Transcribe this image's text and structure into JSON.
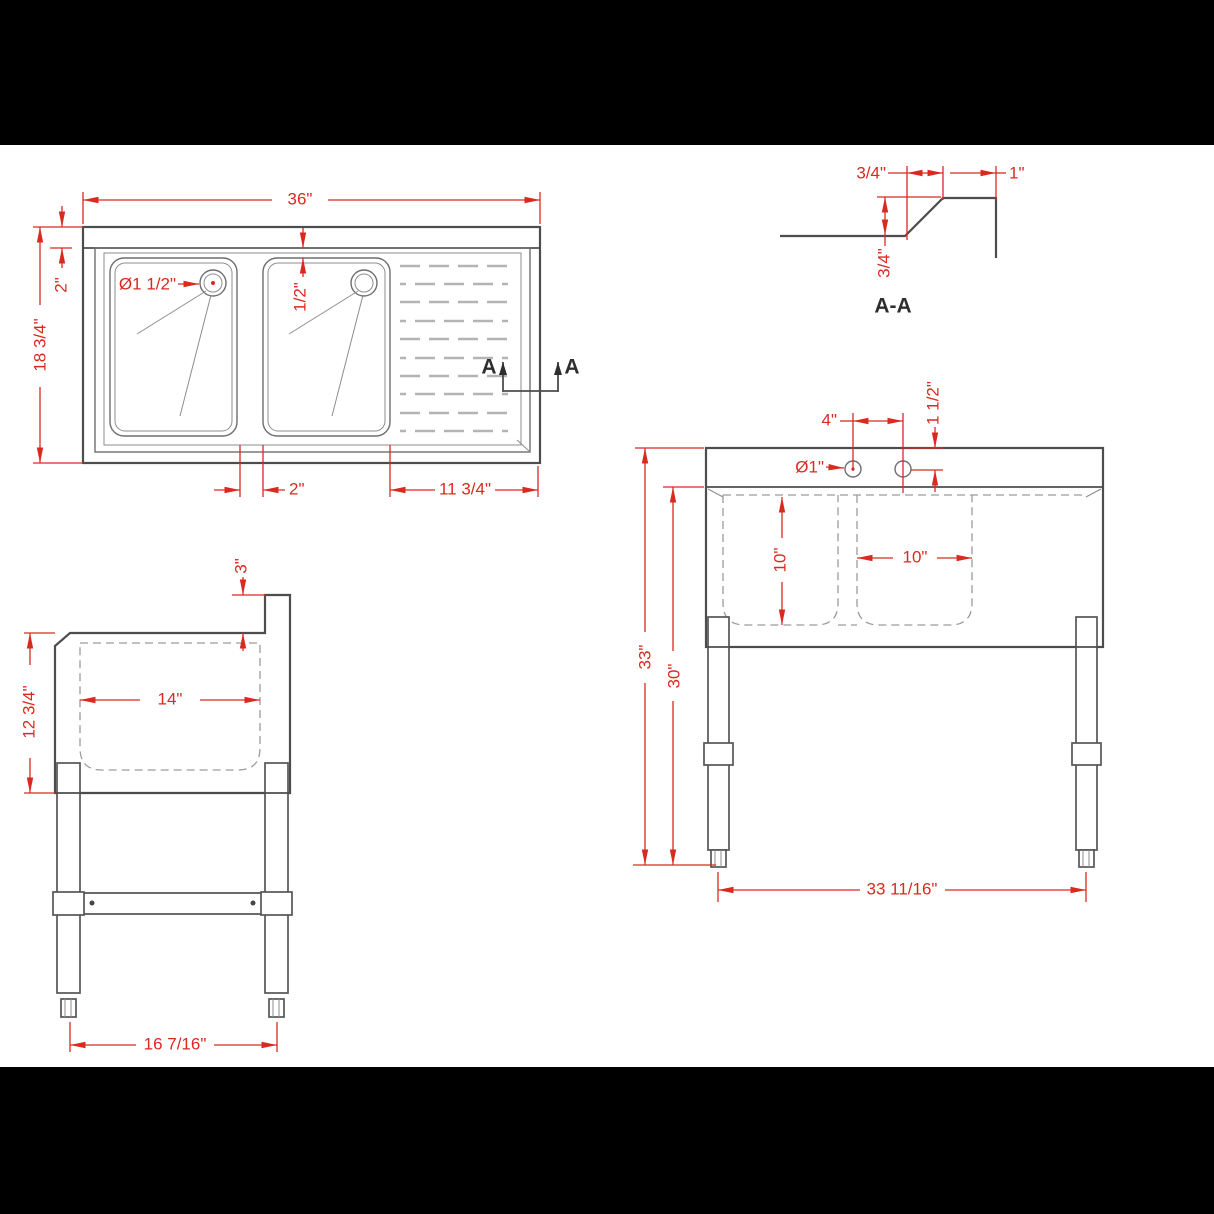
{
  "top_view": {
    "overall_width": "36\"",
    "backsplash_depth": "2\"",
    "overall_depth": "18 3/4\"",
    "drain_diameter": "Ø1 1/2\"",
    "bowl_setback": "1/2\"",
    "bowl_gap": "2\"",
    "drainboard_width": "11 3/4\"",
    "section_marker_left": "A",
    "section_marker_right": "A"
  },
  "section_detail": {
    "title": "A-A",
    "slope_run": "3/4\"",
    "top_flat": "1\"",
    "rise": "3/4\""
  },
  "front_view": {
    "faucet_hole_spacing": "4\"",
    "faucet_hole_offset": "1 1/2\"",
    "faucet_hole_diameter": "Ø1\"",
    "bowl_depth": "10\"",
    "bowl_width": "10\"",
    "overall_height": "33\"",
    "working_height": "30\"",
    "leg_span": "33 11/16\""
  },
  "side_view": {
    "backsplash_height": "3\"",
    "body_height": "12 3/4\"",
    "bowl_front_to_back": "14\"",
    "leg_span": "16 7/16\""
  },
  "colors": {
    "dimension_red": "#da2a20",
    "outline_gray": "#4d4d4d",
    "hidden_line_gray": "#9c9c9c",
    "drawing_background": "#ffffff",
    "letterbox": "#000000"
  }
}
